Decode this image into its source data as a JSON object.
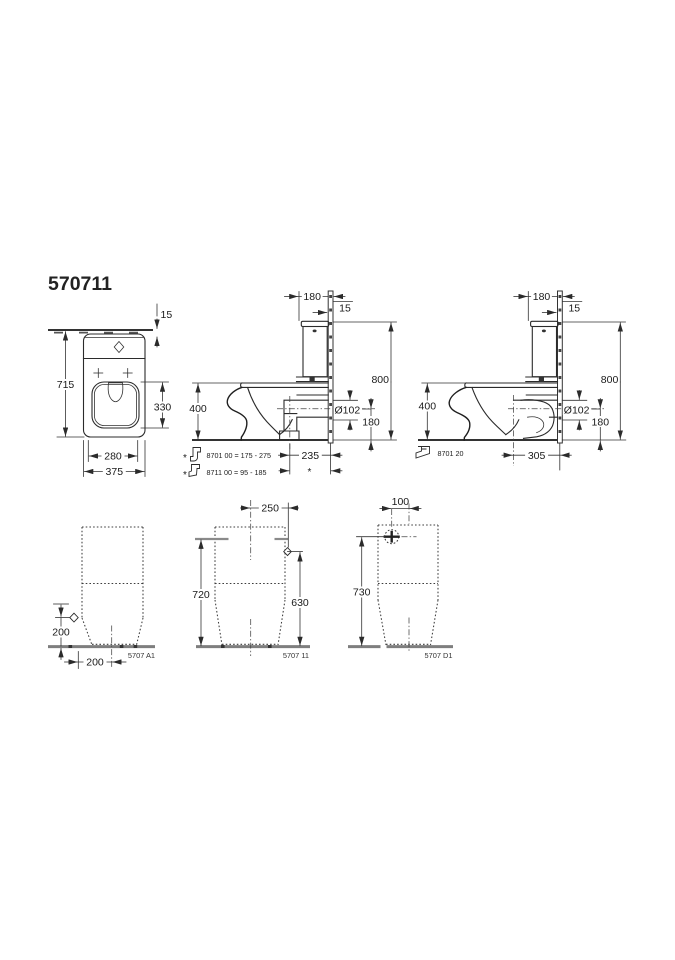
{
  "title": {
    "code": "570711"
  },
  "front_view": {
    "dim_wall_gap": "15",
    "dim_height": "715",
    "dim_opening_height": "330",
    "dim_foot_width": "280",
    "dim_total_width": "375"
  },
  "side_view_vario": {
    "dim_cistern_depth": "180",
    "dim_wall_thickness": "15",
    "dim_total_height": "800",
    "dim_bowl_height": "400",
    "dim_outlet_diameter": "Ø102",
    "dim_outlet_height": "180",
    "dim_outlet_distance": "235",
    "asterisk": "*",
    "notes": [
      {
        "marker": "*",
        "text": "8701 00 = 175 - 275"
      },
      {
        "marker": "*",
        "text": "8711 00 = 95 - 185"
      }
    ]
  },
  "side_view_horizontal": {
    "dim_cistern_depth": "180",
    "dim_wall_thickness": "15",
    "dim_total_height": "800",
    "dim_bowl_height": "400",
    "dim_outlet_diameter": "Ø102",
    "dim_outlet_height": "180",
    "dim_outlet_distance": "305",
    "note": {
      "text": "8701 20"
    }
  },
  "fixing_view_a1": {
    "dim_hole_height": "200",
    "dim_hole_offset": "200",
    "code": "5707 A1"
  },
  "fixing_view_11": {
    "dim_hole_spacing": "250",
    "dim_left_height": "720",
    "dim_right_height": "630",
    "code": "5707 11"
  },
  "fixing_view_d1": {
    "dim_inlet_offset": "100",
    "dim_inlet_height": "730",
    "code": "5707 D1"
  }
}
